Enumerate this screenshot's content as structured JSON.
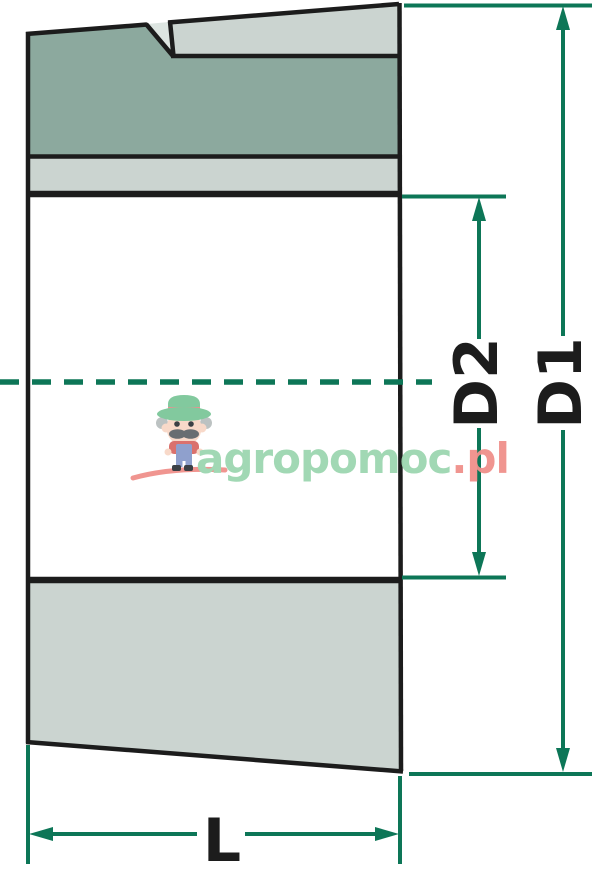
{
  "diagram": {
    "type": "technical-drawing",
    "subject": "tapered bushing cross-section with dimension lines",
    "labels": {
      "d1": "D1",
      "d2": "D2",
      "length": "L"
    }
  },
  "watermark": {
    "brand": "agropomoc",
    "tld": ".pl"
  },
  "colors": {
    "outline": "#1c1c1c",
    "dim": "#0d7657",
    "fill-dark": "#8ca99e",
    "fill-light": "#cbd4d0",
    "fill-notch": "#dde5e1",
    "wm-green": "#9dd6b0",
    "wm-red": "#f0908b",
    "wm-skin": "#f8d8c7",
    "wm-hat": "#7cc799",
    "wm-band": "#ea8b8b",
    "wm-shirt": "#d96a66",
    "wm-denim": "#8a9bcb",
    "wm-grey": "#b9bfbf",
    "wm-dark": "#31363c",
    "wm-stache": "#60666a"
  }
}
